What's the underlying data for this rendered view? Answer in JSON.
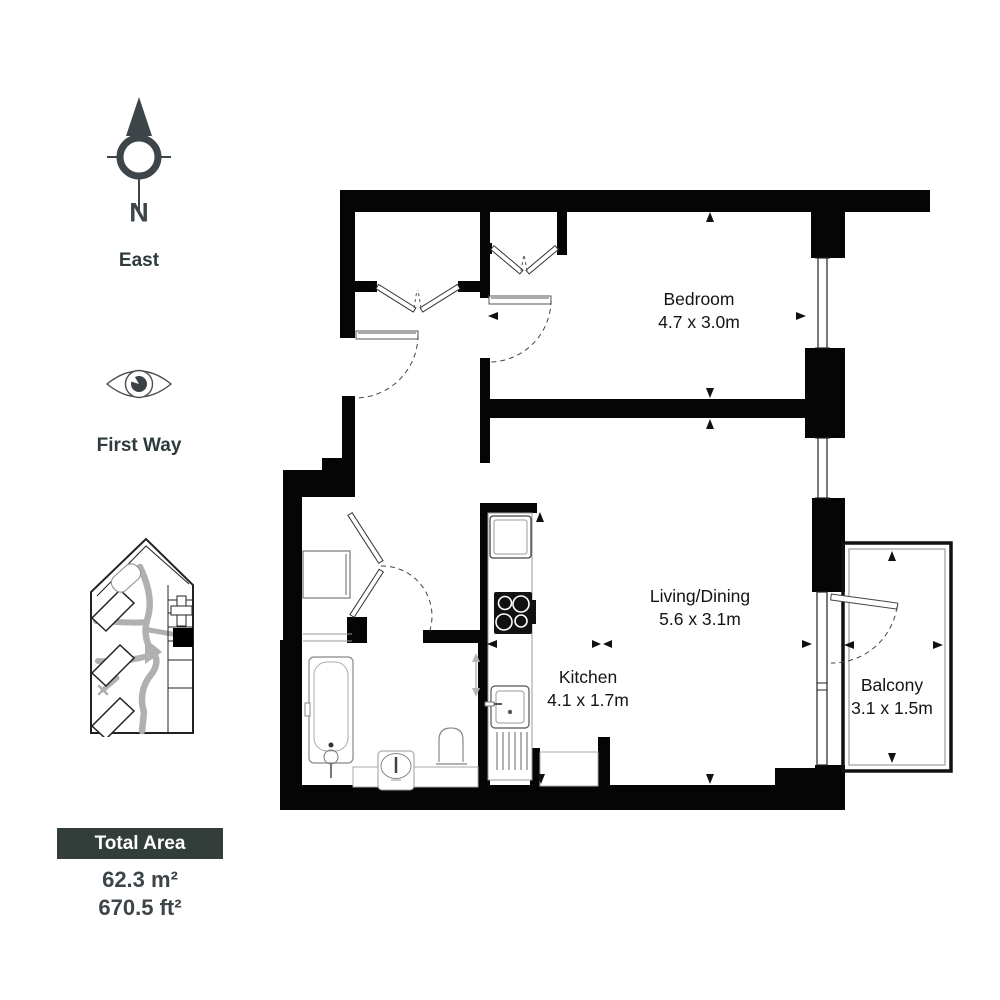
{
  "compass": {
    "north": "N",
    "direction": "East"
  },
  "street": {
    "label": "First Way"
  },
  "total_area": {
    "title": "Total Area",
    "metric": "62.3 m²",
    "imperial": "670.5 ft²"
  },
  "rooms": [
    {
      "name": "Bedroom",
      "dimensions": "4.7 x 3.0m"
    },
    {
      "name": "Living/Dining",
      "dimensions": "5.6 x 3.1m"
    },
    {
      "name": "Kitchen",
      "dimensions": "4.1 x 1.7m"
    },
    {
      "name": "Balcony",
      "dimensions": "3.1 x 1.5m"
    }
  ],
  "icons": {
    "compass": "compass-north-icon",
    "eye": "eye-viewpoint-icon",
    "site_plan": "site-plan-locator-map"
  },
  "colors": {
    "wall": "#050505",
    "text_dark": "#3d4549",
    "label_text": "#141414",
    "total_box_bg": "#333e3a",
    "corridor_gray": "#b0b0b0",
    "background": "#ffffff"
  }
}
